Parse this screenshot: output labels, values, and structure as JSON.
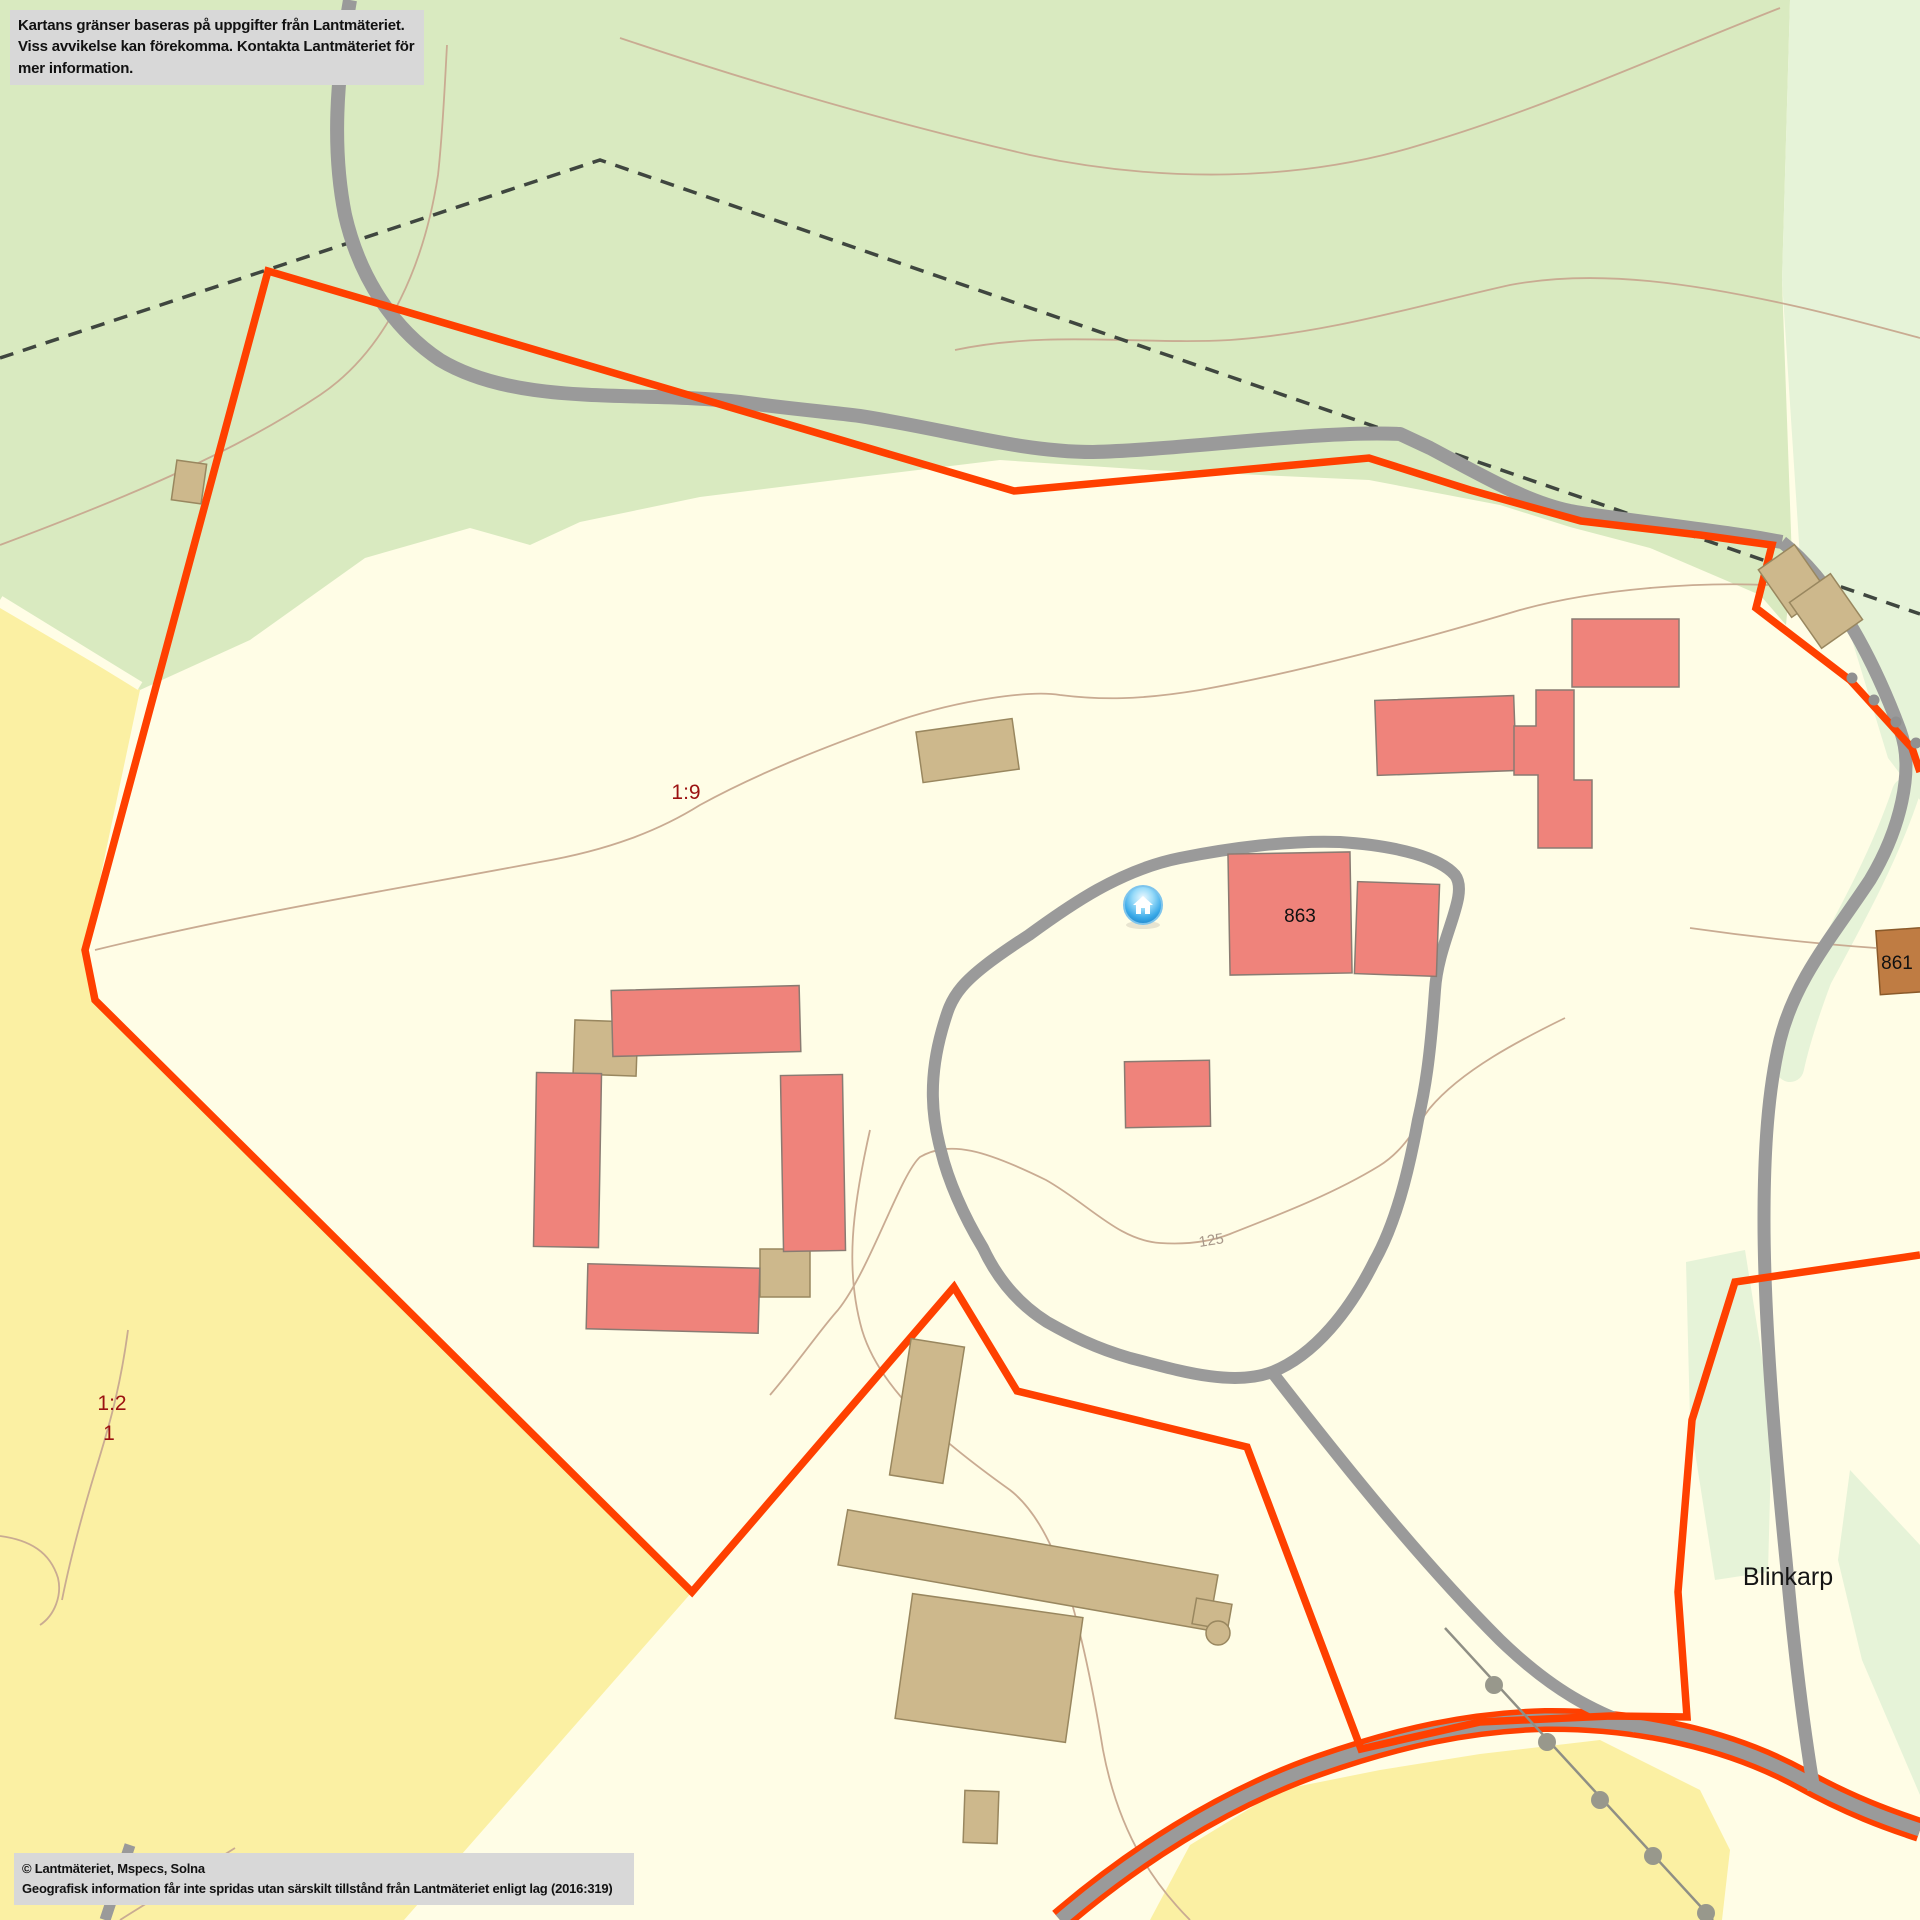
{
  "notice": {
    "line1": "Kartans gränser baseras på uppgifter från Lantmäteriet.",
    "line2": "Viss avvikelse kan förekomma. Kontakta Lantmäteriet för mer information."
  },
  "attribution": {
    "line1": "© Lantmäteriet, Mspecs, Solna",
    "line2": "Geografisk information får inte spridas utan särskilt tillstånd från Lantmäteriet enligt lag (2016:319)"
  },
  "map": {
    "labels": [
      {
        "id": "parcel-1-9",
        "text": "1:9",
        "x": 686,
        "y": 799,
        "cls": "parcel"
      },
      {
        "id": "parcel-1-2",
        "text": "1:2",
        "x": 112,
        "y": 1410,
        "cls": "parcel"
      },
      {
        "id": "parcel-1",
        "text": "1",
        "x": 109,
        "y": 1440,
        "cls": "parcel"
      },
      {
        "id": "building-863",
        "text": "863",
        "x": 1300,
        "y": 922,
        "cls": "bldg"
      },
      {
        "id": "building-861",
        "text": "861",
        "x": 1897,
        "y": 969,
        "cls": "bldg"
      },
      {
        "id": "contour-125",
        "text": "125",
        "x": 1212,
        "y": 1245,
        "cls": "contour",
        "rot": -9
      },
      {
        "id": "place-blinkarp",
        "text": "Blinkarp",
        "x": 1788,
        "y": 1585,
        "cls": "place"
      }
    ],
    "marker": {
      "name": "home-marker",
      "x": 1143,
      "y": 905
    }
  },
  "colors": {
    "background": "#fffde6",
    "forest_green": "#d9eac0",
    "forest_green_light": "#e6f3d8",
    "field_yellow": "#fbf0a3",
    "road_gray": "#9a9a9a",
    "boundary_orange": "#ff4000",
    "building_red": "#ef837b",
    "building_tan": "#cdb88c",
    "building_brown": "#bf7c43",
    "contour_tan": "#c9ab92",
    "parcel_label_red": "#9b1111",
    "notice_gray": "#d8d8d8",
    "marker_blue": "#2f9fe0"
  }
}
